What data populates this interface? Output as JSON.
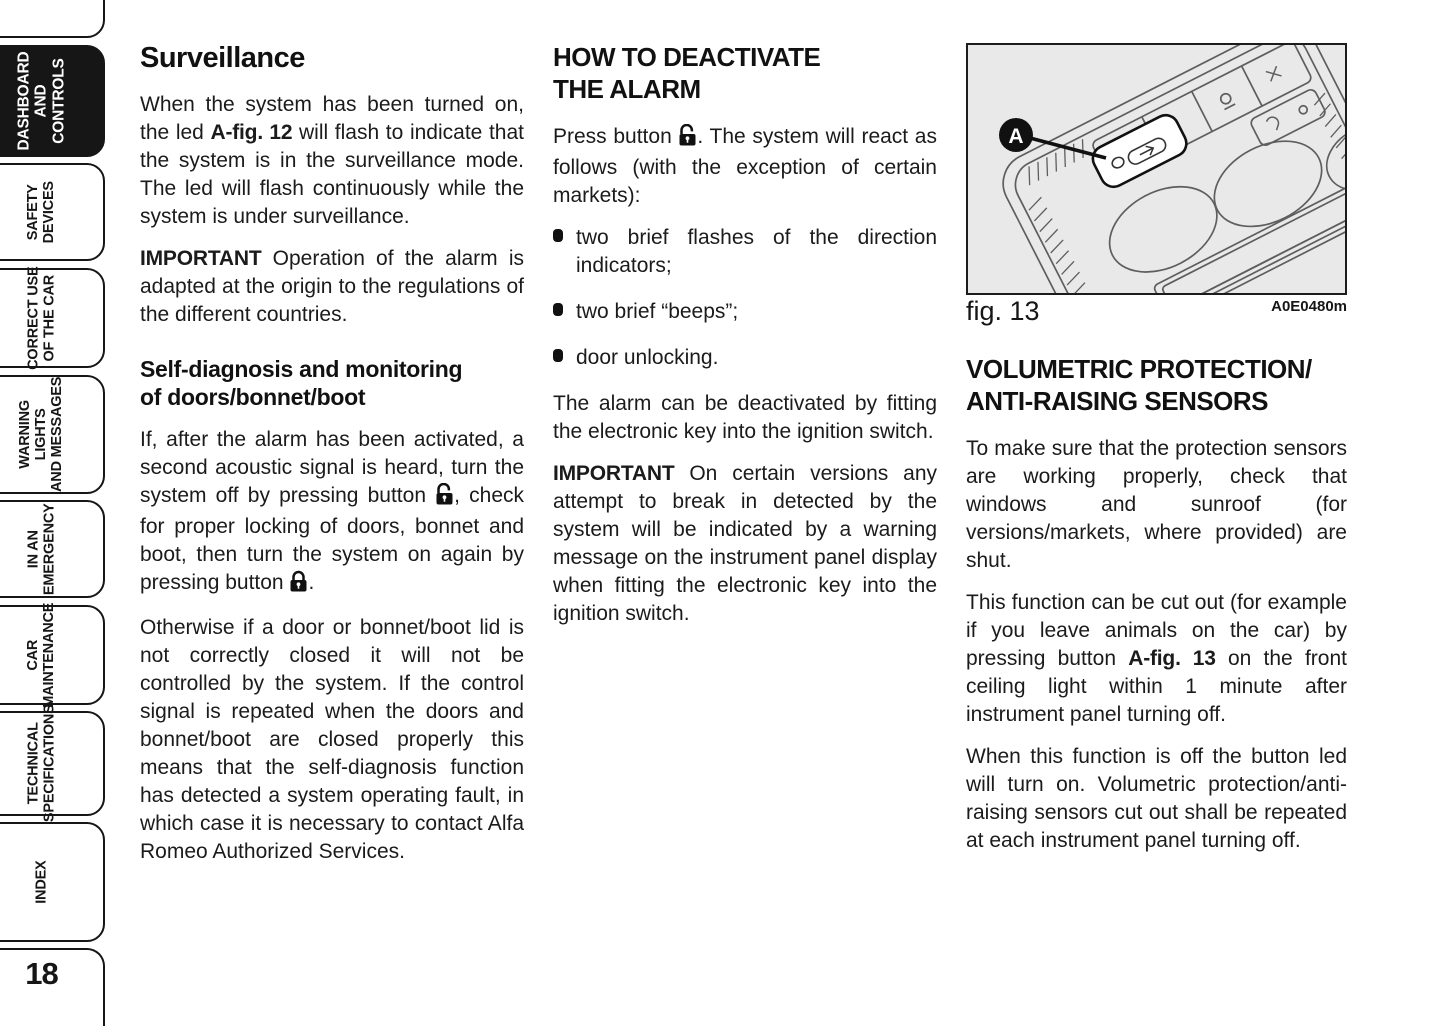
{
  "page": {
    "number": "18"
  },
  "sidebar": {
    "tabs": [
      {
        "label": "DASHBOARD\nAND\nCONTROLS",
        "active": true
      },
      {
        "label": "SAFETY\nDEVICES",
        "active": false
      },
      {
        "label": "CORRECT USE\nOF THE CAR",
        "active": false
      },
      {
        "label": "WARNING LIGHTS\nAND MESSAGES",
        "active": false
      },
      {
        "label": "IN AN\nEMERGENCY",
        "active": false
      },
      {
        "label": "CAR\nMAINTENANCE",
        "active": false
      },
      {
        "label": "TECHNICAL\nSPECIFICATIONS",
        "active": false
      },
      {
        "label": "INDEX",
        "active": false
      }
    ]
  },
  "col1": {
    "heading": "Surveillance",
    "p1_pre": "When the system has been turned on, the led ",
    "p1_bold": "A-fig. 12",
    "p1_post": " will flash to indicate that the system is in the surveillance mode. The led will flash continuously while the system is under surveillance.",
    "p2_bold": "IMPORTANT",
    "p2_text": " Operation of the alarm is adapted at the origin to the regulations of the different countries.",
    "heading2": "Self-diagnosis and monitoring\nof doors/bonnet/boot",
    "p3_pre": "If, after the alarm has been activated, a second acoustic signal is heard, turn the system off by pressing button ",
    "p3_mid": ", check for proper locking of doors, bonnet and boot, then turn the system on again by pressing button ",
    "p3_post": ".",
    "p4": "Otherwise if a door or bonnet/boot lid is not correctly closed it will not be controlled by the system. If the control signal is repeated when the doors and bonnet/boot are closed properly this means that the self-diagnosis function has detected a system operating fault, in which case it is necessary to contact Alfa Romeo Authorized Services."
  },
  "col2": {
    "heading": "HOW TO DEACTIVATE\nTHE ALARM",
    "p1_pre": "Press button ",
    "p1_post": ". The system will react as follows (with the exception of certain markets):",
    "bullets": [
      "two brief flashes of the direction indicators;",
      "two brief “beeps”;",
      "door unlocking."
    ],
    "p2": "The alarm can be deactivated by fitting the electronic key into the ignition switch.",
    "p3_bold": "IMPORTANT",
    "p3_text": " On certain versions any attempt to break in detected by the system will be indicated by a warning message on the instrument panel display when fitting the electronic key into the ignition switch."
  },
  "figure": {
    "caption": "fig. 13",
    "code": "A0E0480m",
    "callout_label": "A"
  },
  "col3": {
    "heading": "VOLUMETRIC PROTECTION/\nANTI-RAISING SENSORS",
    "p1": "To make sure that the protection sensors are working properly, check that windows and sunroof (for versions/markets, where provided) are shut.",
    "p2_pre": "This function can be cut out (for example if you leave animals on the car) by pressing button ",
    "p2_bold": "A-fig. 13",
    "p2_post": " on the front ceiling light within 1 minute after instrument panel turning off.",
    "p3": "When this function is off the button led will turn on. Volumetric protection/anti-raising sensors cut out shall be repeated at each instrument panel turning off."
  },
  "colors": {
    "text": "#1b1b1b",
    "tab_active_bg": "#161616",
    "figure_bg": "#e9e9e9",
    "drawing_line": "#5e5e5e"
  }
}
